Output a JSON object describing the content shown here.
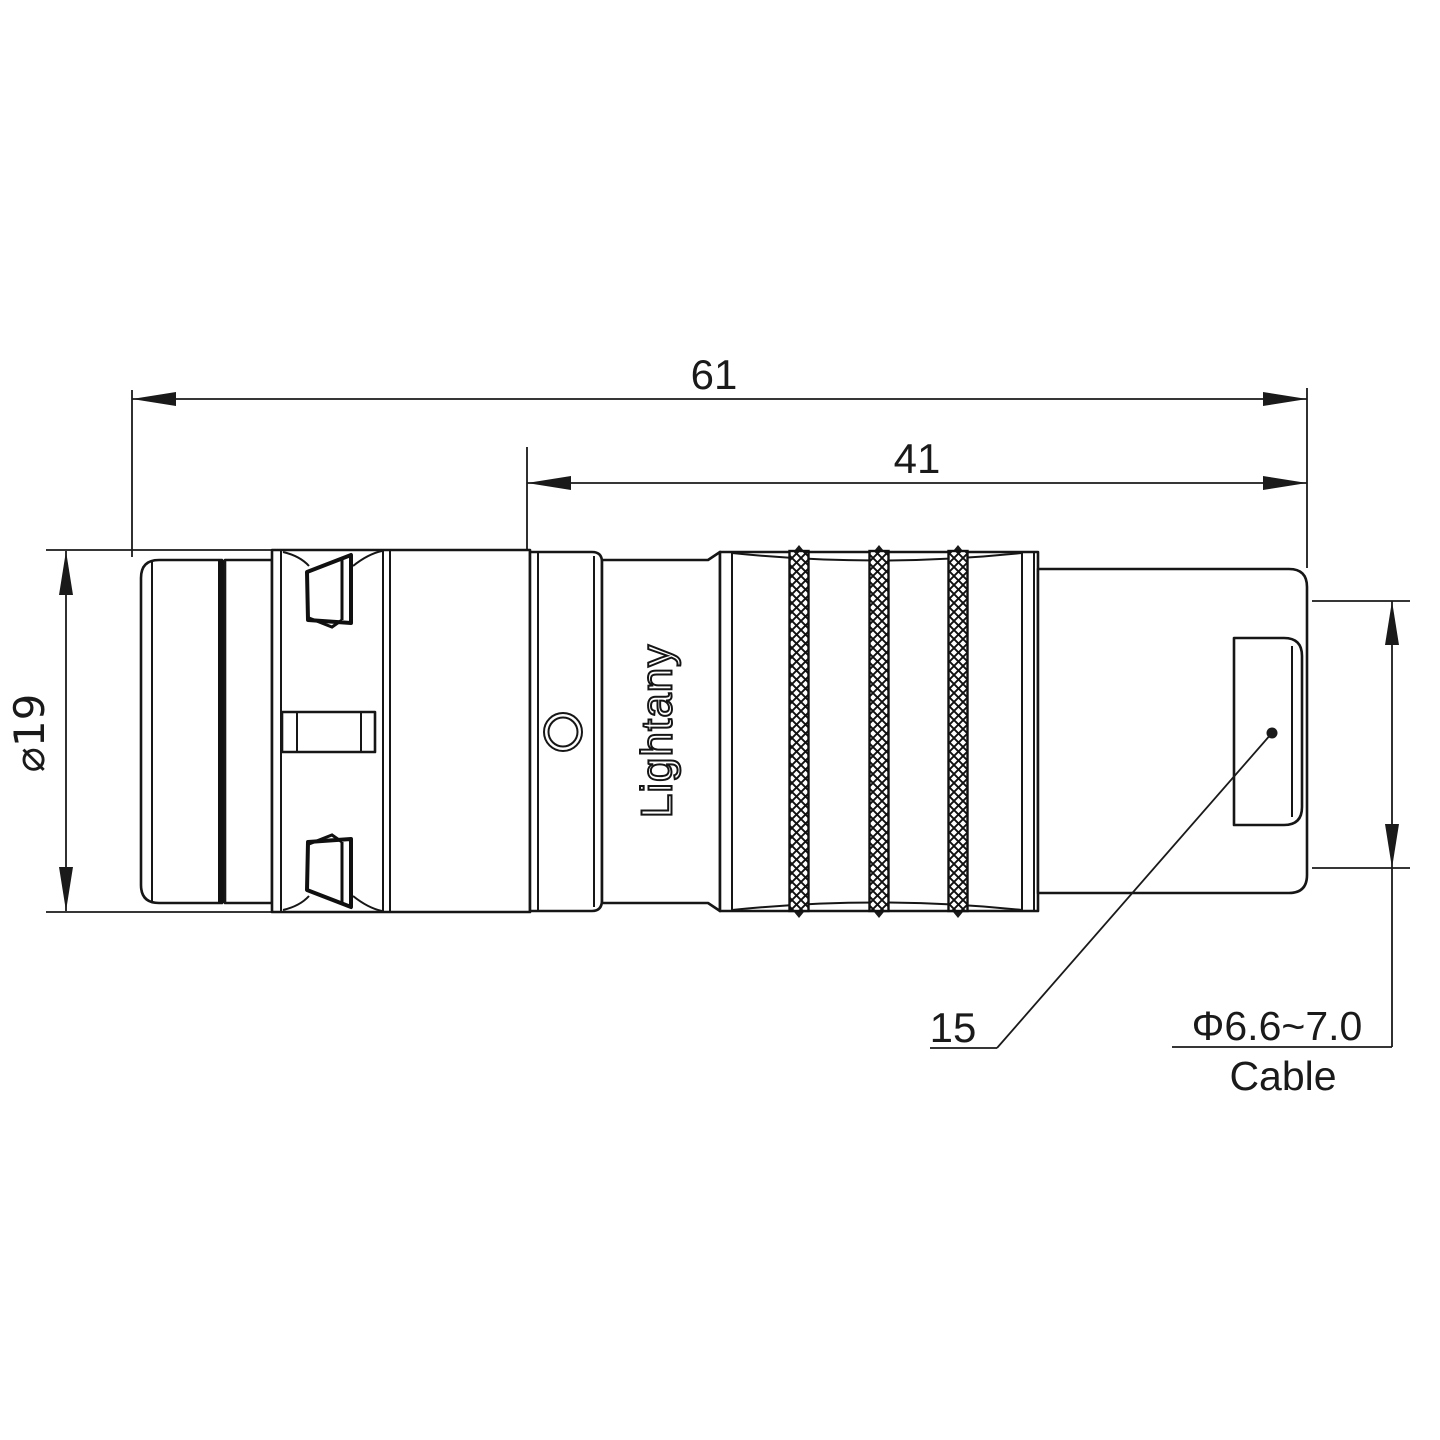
{
  "drawing": {
    "kind": "connector-technical-drawing",
    "dimensions": {
      "overall_length": "61",
      "rear_length": "41",
      "outer_diameter": "⌀19",
      "rear_size": "15",
      "cable_diameter": "Φ6.6~7.0",
      "cable_word": "Cable"
    },
    "branding": {
      "body_text": "Lightany",
      "watermark": "Lightany"
    },
    "colors": {
      "line": "#1a1a1a",
      "background": "#ffffff",
      "watermark": "#eeafaf",
      "band_fill": "#111111"
    }
  }
}
